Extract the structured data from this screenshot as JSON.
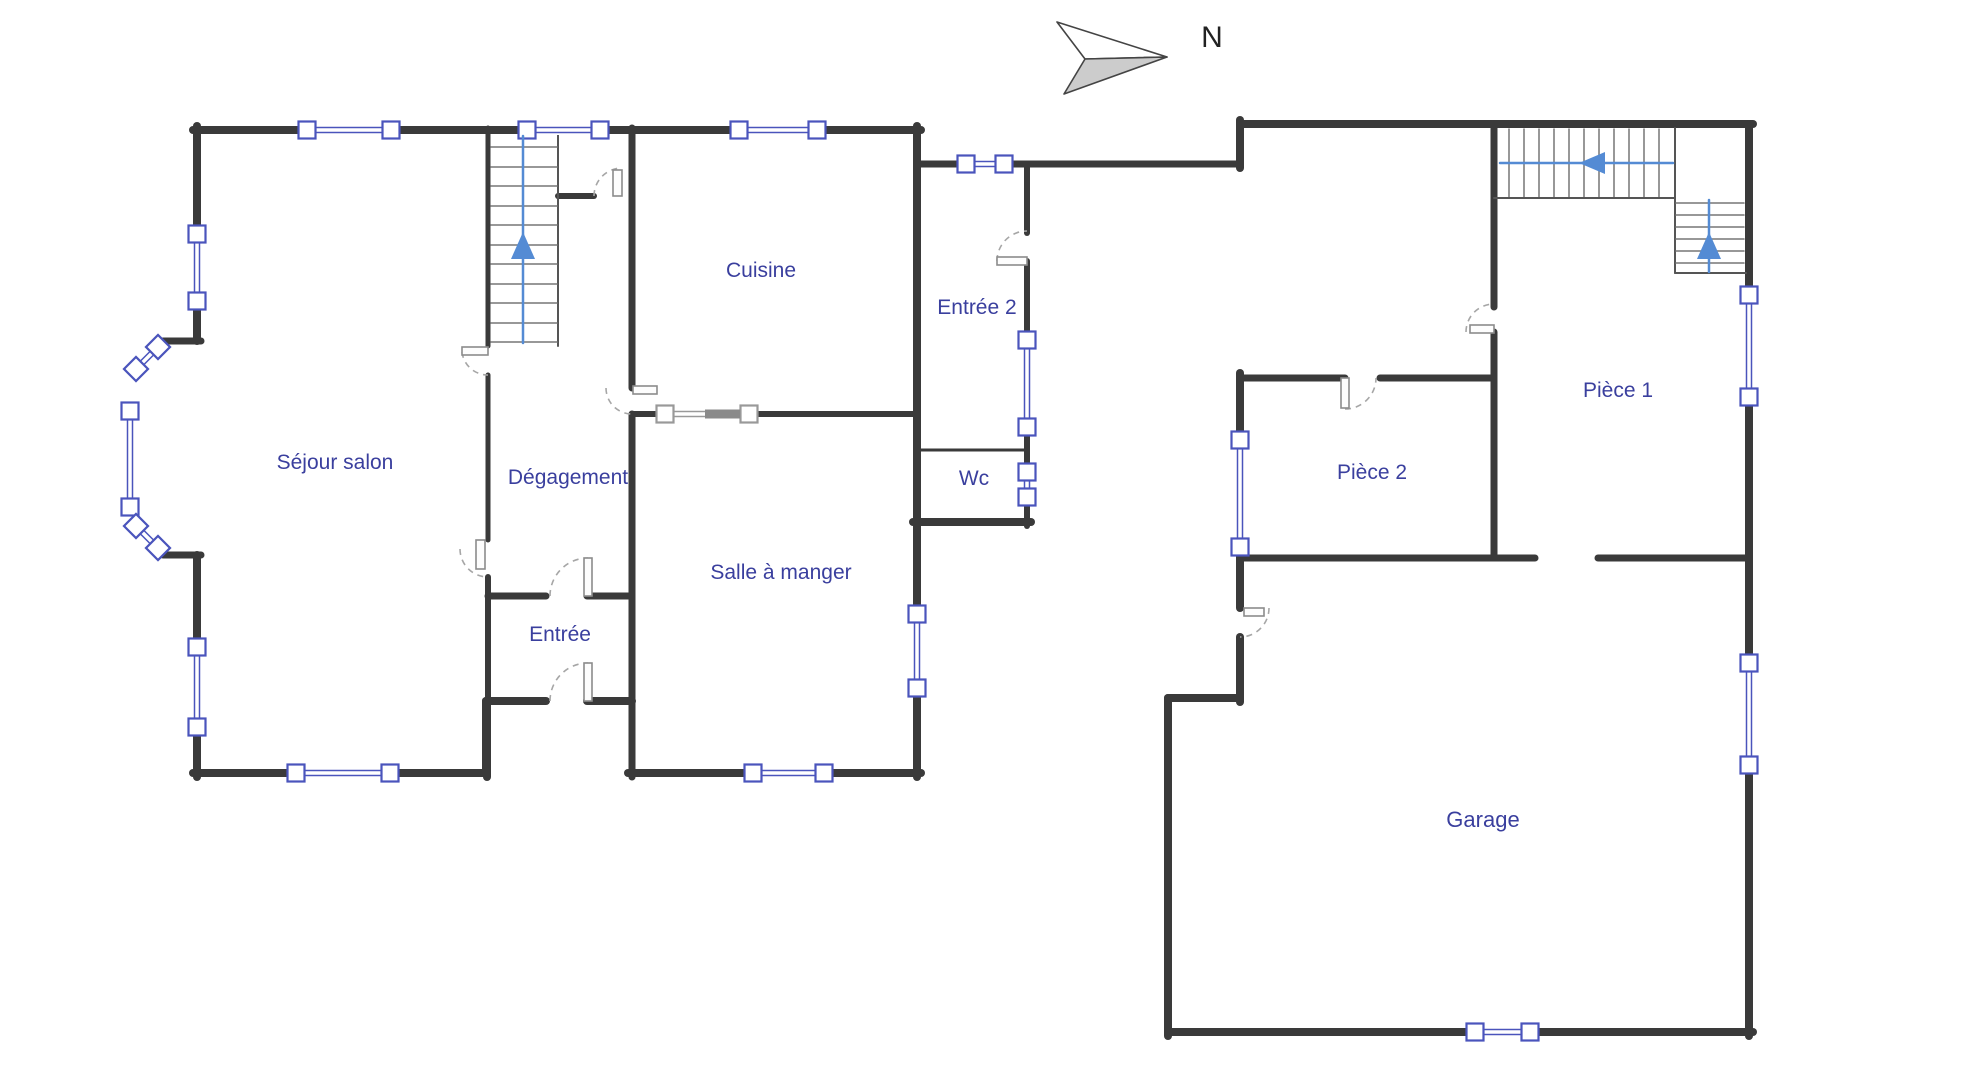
{
  "colors": {
    "wall": "#3a3a3a",
    "thin": "#6a6a6a",
    "window_ext": "#4a54bc",
    "window_int": "#999999",
    "handle_fill": "#ffffff",
    "door_panel": "#fdfdfd",
    "door_stroke": "#8c8c8c",
    "door_arc": "#a6a6a6",
    "stair_arrow": "#548bd4",
    "label": "#3a3f9e",
    "north_fill": "#cccccc",
    "north_stroke": "#444444",
    "north_text": "#222222"
  },
  "north": {
    "label": "N",
    "text_x": 1212,
    "text_y": 47,
    "font_size": 30,
    "poly_top": "1167,57 1057,22 1085,59",
    "poly_bottom": "1167,57 1085,59 1064,94"
  },
  "rooms": [
    {
      "id": "sejour-salon",
      "name": "Séjour salon",
      "x": 335,
      "y": 469,
      "size": 21
    },
    {
      "id": "degagement",
      "name": "Dégagement",
      "x": 568,
      "y": 484,
      "size": 21
    },
    {
      "id": "cuisine",
      "name": "Cuisine",
      "x": 761,
      "y": 277,
      "size": 21
    },
    {
      "id": "entree",
      "name": "Entrée",
      "x": 560,
      "y": 641,
      "size": 21
    },
    {
      "id": "salle-a-manger",
      "name": "Salle à manger",
      "x": 781,
      "y": 579,
      "size": 21
    },
    {
      "id": "entree-2",
      "name": "Entrée 2",
      "x": 977,
      "y": 314,
      "size": 21
    },
    {
      "id": "wc",
      "name": "Wc",
      "x": 974,
      "y": 485,
      "size": 21
    },
    {
      "id": "piece-1",
      "name": "Pièce 1",
      "x": 1618,
      "y": 397,
      "size": 21
    },
    {
      "id": "piece-2",
      "name": "Pièce 2",
      "x": 1372,
      "y": 479,
      "size": 21
    },
    {
      "id": "garage",
      "name": "Garage",
      "x": 1483,
      "y": 827,
      "size": 22
    }
  ],
  "plan": {
    "walls": [
      {
        "x1": 193,
        "y1": 130,
        "x2": 921,
        "y2": 130,
        "w": 8
      },
      {
        "x1": 197,
        "y1": 126,
        "x2": 197,
        "y2": 341,
        "w": 8
      },
      {
        "x1": 163,
        "y1": 341,
        "x2": 201,
        "y2": 341,
        "w": 7
      },
      {
        "x1": 163,
        "y1": 555,
        "x2": 201,
        "y2": 555,
        "w": 7
      },
      {
        "x1": 197,
        "y1": 555,
        "x2": 197,
        "y2": 777,
        "w": 8
      },
      {
        "x1": 193,
        "y1": 773,
        "x2": 486,
        "y2": 773,
        "w": 8
      },
      {
        "x1": 486,
        "y1": 773,
        "x2": 486,
        "y2": 701,
        "w": 8
      },
      {
        "x1": 486,
        "y1": 701,
        "x2": 546,
        "y2": 701,
        "w": 8
      },
      {
        "x1": 587,
        "y1": 701,
        "x2": 632,
        "y2": 701,
        "w": 8
      },
      {
        "x1": 628,
        "y1": 773,
        "x2": 921,
        "y2": 773,
        "w": 8
      },
      {
        "x1": 917,
        "y1": 126,
        "x2": 917,
        "y2": 777,
        "w": 8
      },
      {
        "x1": 632,
        "y1": 128,
        "x2": 632,
        "y2": 388,
        "w": 7
      },
      {
        "x1": 632,
        "y1": 414,
        "x2": 632,
        "y2": 777,
        "w": 7
      },
      {
        "x1": 632,
        "y1": 414,
        "x2": 657,
        "y2": 414,
        "w": 6
      },
      {
        "x1": 757,
        "y1": 414,
        "x2": 917,
        "y2": 414,
        "w": 6
      },
      {
        "x1": 488,
        "y1": 128,
        "x2": 488,
        "y2": 346,
        "w": 5
      },
      {
        "x1": 488,
        "y1": 375,
        "x2": 488,
        "y2": 540,
        "w": 5
      },
      {
        "x1": 488,
        "y1": 577,
        "x2": 488,
        "y2": 705,
        "w": 6
      },
      {
        "x1": 487,
        "y1": 701,
        "x2": 487,
        "y2": 777,
        "w": 8
      },
      {
        "x1": 488,
        "y1": 596,
        "x2": 546,
        "y2": 596,
        "w": 7
      },
      {
        "x1": 587,
        "y1": 596,
        "x2": 632,
        "y2": 596,
        "w": 7
      },
      {
        "x1": 558,
        "y1": 196,
        "x2": 594,
        "y2": 196,
        "w": 6
      },
      {
        "x1": 917,
        "y1": 164,
        "x2": 1240,
        "y2": 164,
        "w": 7
      },
      {
        "x1": 1240,
        "y1": 168,
        "x2": 1240,
        "y2": 120,
        "w": 8
      },
      {
        "x1": 1027,
        "y1": 164,
        "x2": 1027,
        "y2": 233,
        "w": 6
      },
      {
        "x1": 1027,
        "y1": 261,
        "x2": 1027,
        "y2": 526,
        "w": 6
      },
      {
        "x1": 917,
        "y1": 450,
        "x2": 1027,
        "y2": 450,
        "w": 3
      },
      {
        "x1": 913,
        "y1": 522,
        "x2": 1031,
        "y2": 522,
        "w": 8
      },
      {
        "x1": 1240,
        "y1": 124,
        "x2": 1753,
        "y2": 124,
        "w": 8
      },
      {
        "x1": 1749,
        "y1": 124,
        "x2": 1749,
        "y2": 1036,
        "w": 8
      },
      {
        "x1": 1168,
        "y1": 1032,
        "x2": 1753,
        "y2": 1032,
        "w": 8
      },
      {
        "x1": 1168,
        "y1": 698,
        "x2": 1168,
        "y2": 1036,
        "w": 8
      },
      {
        "x1": 1168,
        "y1": 698,
        "x2": 1240,
        "y2": 698,
        "w": 8
      },
      {
        "x1": 1240,
        "y1": 373,
        "x2": 1240,
        "y2": 608,
        "w": 8
      },
      {
        "x1": 1240,
        "y1": 637,
        "x2": 1240,
        "y2": 702,
        "w": 8
      },
      {
        "x1": 1240,
        "y1": 378,
        "x2": 1345,
        "y2": 378,
        "w": 7
      },
      {
        "x1": 1380,
        "y1": 378,
        "x2": 1494,
        "y2": 378,
        "w": 7
      },
      {
        "x1": 1494,
        "y1": 124,
        "x2": 1494,
        "y2": 307,
        "w": 7
      },
      {
        "x1": 1494,
        "y1": 332,
        "x2": 1494,
        "y2": 558,
        "w": 7
      },
      {
        "x1": 1240,
        "y1": 558,
        "x2": 1535,
        "y2": 558,
        "w": 7
      },
      {
        "x1": 1598,
        "y1": 558,
        "x2": 1749,
        "y2": 558,
        "w": 7
      }
    ],
    "thin_lines": [
      {
        "x1": 558,
        "y1": 130,
        "x2": 558,
        "y2": 346,
        "w": 2,
        "c": "#555555"
      },
      {
        "x1": 491,
        "y1": 147,
        "x2": 557,
        "y2": 147,
        "w": 1.5,
        "c": "#777777"
      },
      {
        "x1": 491,
        "y1": 167,
        "x2": 557,
        "y2": 167,
        "w": 1.5,
        "c": "#777777"
      },
      {
        "x1": 491,
        "y1": 186,
        "x2": 557,
        "y2": 186,
        "w": 1.5,
        "c": "#777777"
      },
      {
        "x1": 491,
        "y1": 206,
        "x2": 557,
        "y2": 206,
        "w": 1.5,
        "c": "#777777"
      },
      {
        "x1": 491,
        "y1": 225,
        "x2": 557,
        "y2": 225,
        "w": 1.5,
        "c": "#777777"
      },
      {
        "x1": 491,
        "y1": 245,
        "x2": 557,
        "y2": 245,
        "w": 1.5,
        "c": "#777777"
      },
      {
        "x1": 491,
        "y1": 264,
        "x2": 557,
        "y2": 264,
        "w": 1.5,
        "c": "#777777"
      },
      {
        "x1": 491,
        "y1": 284,
        "x2": 557,
        "y2": 284,
        "w": 1.5,
        "c": "#777777"
      },
      {
        "x1": 491,
        "y1": 303,
        "x2": 557,
        "y2": 303,
        "w": 1.5,
        "c": "#777777"
      },
      {
        "x1": 491,
        "y1": 323,
        "x2": 557,
        "y2": 323,
        "w": 1.5,
        "c": "#777777"
      },
      {
        "x1": 491,
        "y1": 342,
        "x2": 557,
        "y2": 342,
        "w": 1.5,
        "c": "#777777"
      },
      {
        "x1": 1509,
        "y1": 129,
        "x2": 1509,
        "y2": 197,
        "w": 1.5,
        "c": "#777777"
      },
      {
        "x1": 1524,
        "y1": 129,
        "x2": 1524,
        "y2": 197,
        "w": 1.5,
        "c": "#777777"
      },
      {
        "x1": 1539,
        "y1": 129,
        "x2": 1539,
        "y2": 197,
        "w": 1.5,
        "c": "#777777"
      },
      {
        "x1": 1554,
        "y1": 129,
        "x2": 1554,
        "y2": 197,
        "w": 1.5,
        "c": "#777777"
      },
      {
        "x1": 1569,
        "y1": 129,
        "x2": 1569,
        "y2": 197,
        "w": 1.5,
        "c": "#777777"
      },
      {
        "x1": 1584,
        "y1": 129,
        "x2": 1584,
        "y2": 197,
        "w": 1.5,
        "c": "#777777"
      },
      {
        "x1": 1599,
        "y1": 129,
        "x2": 1599,
        "y2": 197,
        "w": 1.5,
        "c": "#777777"
      },
      {
        "x1": 1614,
        "y1": 129,
        "x2": 1614,
        "y2": 197,
        "w": 1.5,
        "c": "#777777"
      },
      {
        "x1": 1629,
        "y1": 129,
        "x2": 1629,
        "y2": 197,
        "w": 1.5,
        "c": "#777777"
      },
      {
        "x1": 1644,
        "y1": 129,
        "x2": 1644,
        "y2": 197,
        "w": 1.5,
        "c": "#777777"
      },
      {
        "x1": 1659,
        "y1": 129,
        "x2": 1659,
        "y2": 197,
        "w": 1.5,
        "c": "#777777"
      },
      {
        "x1": 1494,
        "y1": 198,
        "x2": 1675,
        "y2": 198,
        "w": 2,
        "c": "#555555"
      },
      {
        "x1": 1675,
        "y1": 128,
        "x2": 1675,
        "y2": 273,
        "w": 2,
        "c": "#555555"
      },
      {
        "x1": 1675,
        "y1": 273,
        "x2": 1746,
        "y2": 273,
        "w": 2,
        "c": "#555555"
      },
      {
        "x1": 1676,
        "y1": 203,
        "x2": 1744,
        "y2": 203,
        "w": 1.5,
        "c": "#777777"
      },
      {
        "x1": 1676,
        "y1": 215,
        "x2": 1744,
        "y2": 215,
        "w": 1.5,
        "c": "#777777"
      },
      {
        "x1": 1676,
        "y1": 227,
        "x2": 1744,
        "y2": 227,
        "w": 1.5,
        "c": "#777777"
      },
      {
        "x1": 1676,
        "y1": 239,
        "x2": 1744,
        "y2": 239,
        "w": 1.5,
        "c": "#777777"
      },
      {
        "x1": 1676,
        "y1": 251,
        "x2": 1744,
        "y2": 251,
        "w": 1.5,
        "c": "#777777"
      },
      {
        "x1": 1676,
        "y1": 263,
        "x2": 1744,
        "y2": 263,
        "w": 1.5,
        "c": "#777777"
      }
    ],
    "stair_arrow_lines": [
      {
        "x1": 523,
        "y1": 136,
        "x2": 523,
        "y2": 343
      },
      {
        "x1": 1500,
        "y1": 163,
        "x2": 1673,
        "y2": 163
      },
      {
        "x1": 1709,
        "y1": 200,
        "x2": 1709,
        "y2": 272
      }
    ],
    "arrows": [
      {
        "points": "523,232 511,259 535,259"
      },
      {
        "points": "1579,163 1605,152 1605,174"
      },
      {
        "points": "1709,232 1697,259 1721,259"
      }
    ],
    "windows": [
      {
        "x1": 307,
        "y1": 130,
        "x2": 391,
        "y2": 130,
        "t": "ext"
      },
      {
        "x1": 527,
        "y1": 130,
        "x2": 600,
        "y2": 130,
        "t": "ext"
      },
      {
        "x1": 739,
        "y1": 130,
        "x2": 817,
        "y2": 130,
        "t": "ext"
      },
      {
        "x1": 197,
        "y1": 234,
        "x2": 197,
        "y2": 301,
        "t": "ext"
      },
      {
        "x1": 158,
        "y1": 347,
        "x2": 136,
        "y2": 369,
        "t": "ext"
      },
      {
        "x1": 130,
        "y1": 411,
        "x2": 130,
        "y2": 507,
        "t": "ext"
      },
      {
        "x1": 136,
        "y1": 526,
        "x2": 158,
        "y2": 548,
        "t": "ext"
      },
      {
        "x1": 197,
        "y1": 647,
        "x2": 197,
        "y2": 727,
        "t": "ext"
      },
      {
        "x1": 296,
        "y1": 773,
        "x2": 390,
        "y2": 773,
        "t": "ext"
      },
      {
        "x1": 753,
        "y1": 773,
        "x2": 824,
        "y2": 773,
        "t": "ext"
      },
      {
        "x1": 917,
        "y1": 614,
        "x2": 917,
        "y2": 688,
        "t": "ext"
      },
      {
        "x1": 966,
        "y1": 164,
        "x2": 1004,
        "y2": 164,
        "t": "ext"
      },
      {
        "x1": 1027,
        "y1": 340,
        "x2": 1027,
        "y2": 427,
        "t": "ext"
      },
      {
        "x1": 1027,
        "y1": 472,
        "x2": 1027,
        "y2": 497,
        "t": "ext"
      },
      {
        "x1": 1240,
        "y1": 440,
        "x2": 1240,
        "y2": 547,
        "t": "ext"
      },
      {
        "x1": 1749,
        "y1": 295,
        "x2": 1749,
        "y2": 397,
        "t": "ext"
      },
      {
        "x1": 1749,
        "y1": 663,
        "x2": 1749,
        "y2": 765,
        "t": "ext"
      },
      {
        "x1": 1475,
        "y1": 1032,
        "x2": 1530,
        "y2": 1032,
        "t": "ext"
      },
      {
        "x1": 665,
        "y1": 414,
        "x2": 749,
        "y2": 414,
        "t": "int"
      }
    ],
    "bars": [
      {
        "x": 705,
        "y": 409.5,
        "w": 35,
        "h": 9,
        "c": "#8a8a8a"
      }
    ],
    "doors": [
      {
        "panel": [
          462,
          347,
          26,
          8
        ],
        "arc": "M462,352 A26,26 0 0 0 488,375"
      },
      {
        "panel": [
          476,
          540,
          9,
          29
        ],
        "arc": "M460,549 A28,28 0 0 0 488,577"
      },
      {
        "panel": [
          584,
          558,
          8,
          38
        ],
        "arc": "M550,596 A38,38 0 0 1 588,558"
      },
      {
        "panel": [
          584,
          663,
          8,
          38
        ],
        "arc": "M550,701 A38,38 0 0 1 588,663"
      },
      {
        "panel": [
          613,
          170,
          9,
          26
        ],
        "arc": "M594,196 A28,28 0 0 1 622,168"
      },
      {
        "panel": [
          633,
          386,
          24,
          8
        ],
        "arc": "M606,388 A26,26 0 0 0 632,414"
      },
      {
        "panel": [
          997,
          257,
          30,
          8
        ],
        "arc": "M997,261 A30,30 0 0 1 1027,231"
      },
      {
        "panel": [
          1341,
          378,
          8,
          30
        ],
        "arc": "M1345,409 A31,31 0 0 0 1376,378"
      },
      {
        "panel": [
          1470,
          325,
          24,
          8
        ],
        "arc": "M1466,332 A28,28 0 0 1 1494,304"
      },
      {
        "panel": [
          1244,
          608,
          20,
          8
        ],
        "arc": "M1269,608 A29,29 0 0 1 1240,637"
      }
    ]
  }
}
